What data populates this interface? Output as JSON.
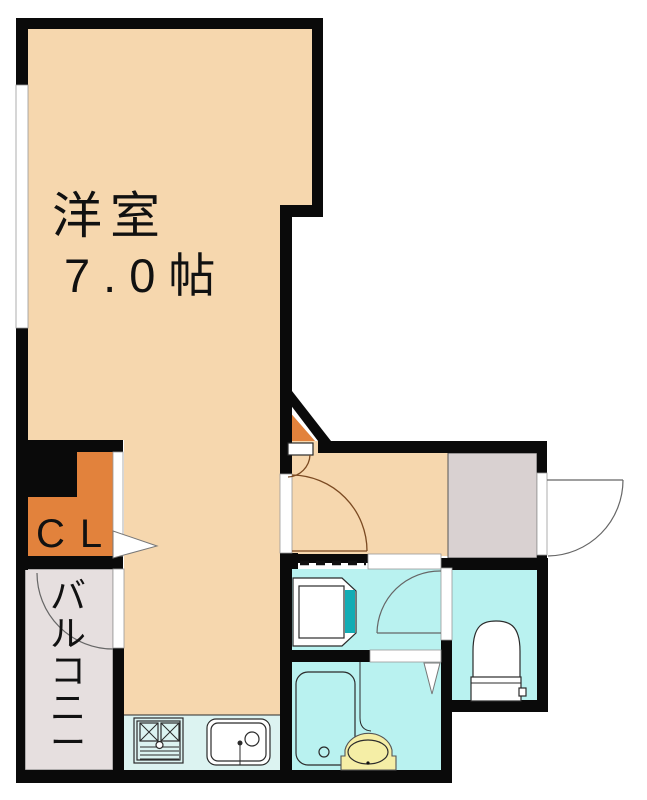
{
  "plan": {
    "type": "apartment-floor-plan",
    "rooms": {
      "main": {
        "name": "洋室",
        "size": "7.0帖"
      },
      "closet": {
        "label": "CL"
      },
      "balcony": {
        "label": "バルコニー",
        "chars": [
          "バ",
          "ル",
          "コ",
          "ニ",
          "ー"
        ]
      }
    },
    "fixtures": [
      "bathtub",
      "wash-basin",
      "toilet",
      "washer-space",
      "stove",
      "kitchen-sink",
      "shoe-cabinet"
    ],
    "doors": [
      "main-room-door",
      "front-door",
      "toilet-door",
      "balcony-door",
      "closet-opening",
      "bathroom-opening"
    ]
  },
  "colors": {
    "wall": "#0a0a0a",
    "peach": "#f6d7ae",
    "orange": "#e2823c",
    "cyan": "#b9f2f0",
    "cyan_pale": "#dcf3f1",
    "gray_genkan": "#d9d1d1",
    "gray_balcony": "#e6dfdf",
    "teal": "#12acb4",
    "yellow": "#f5eea6",
    "arc_brown": "#7b4a22",
    "line_gray": "#666666",
    "outline": "#2b2b2b"
  }
}
